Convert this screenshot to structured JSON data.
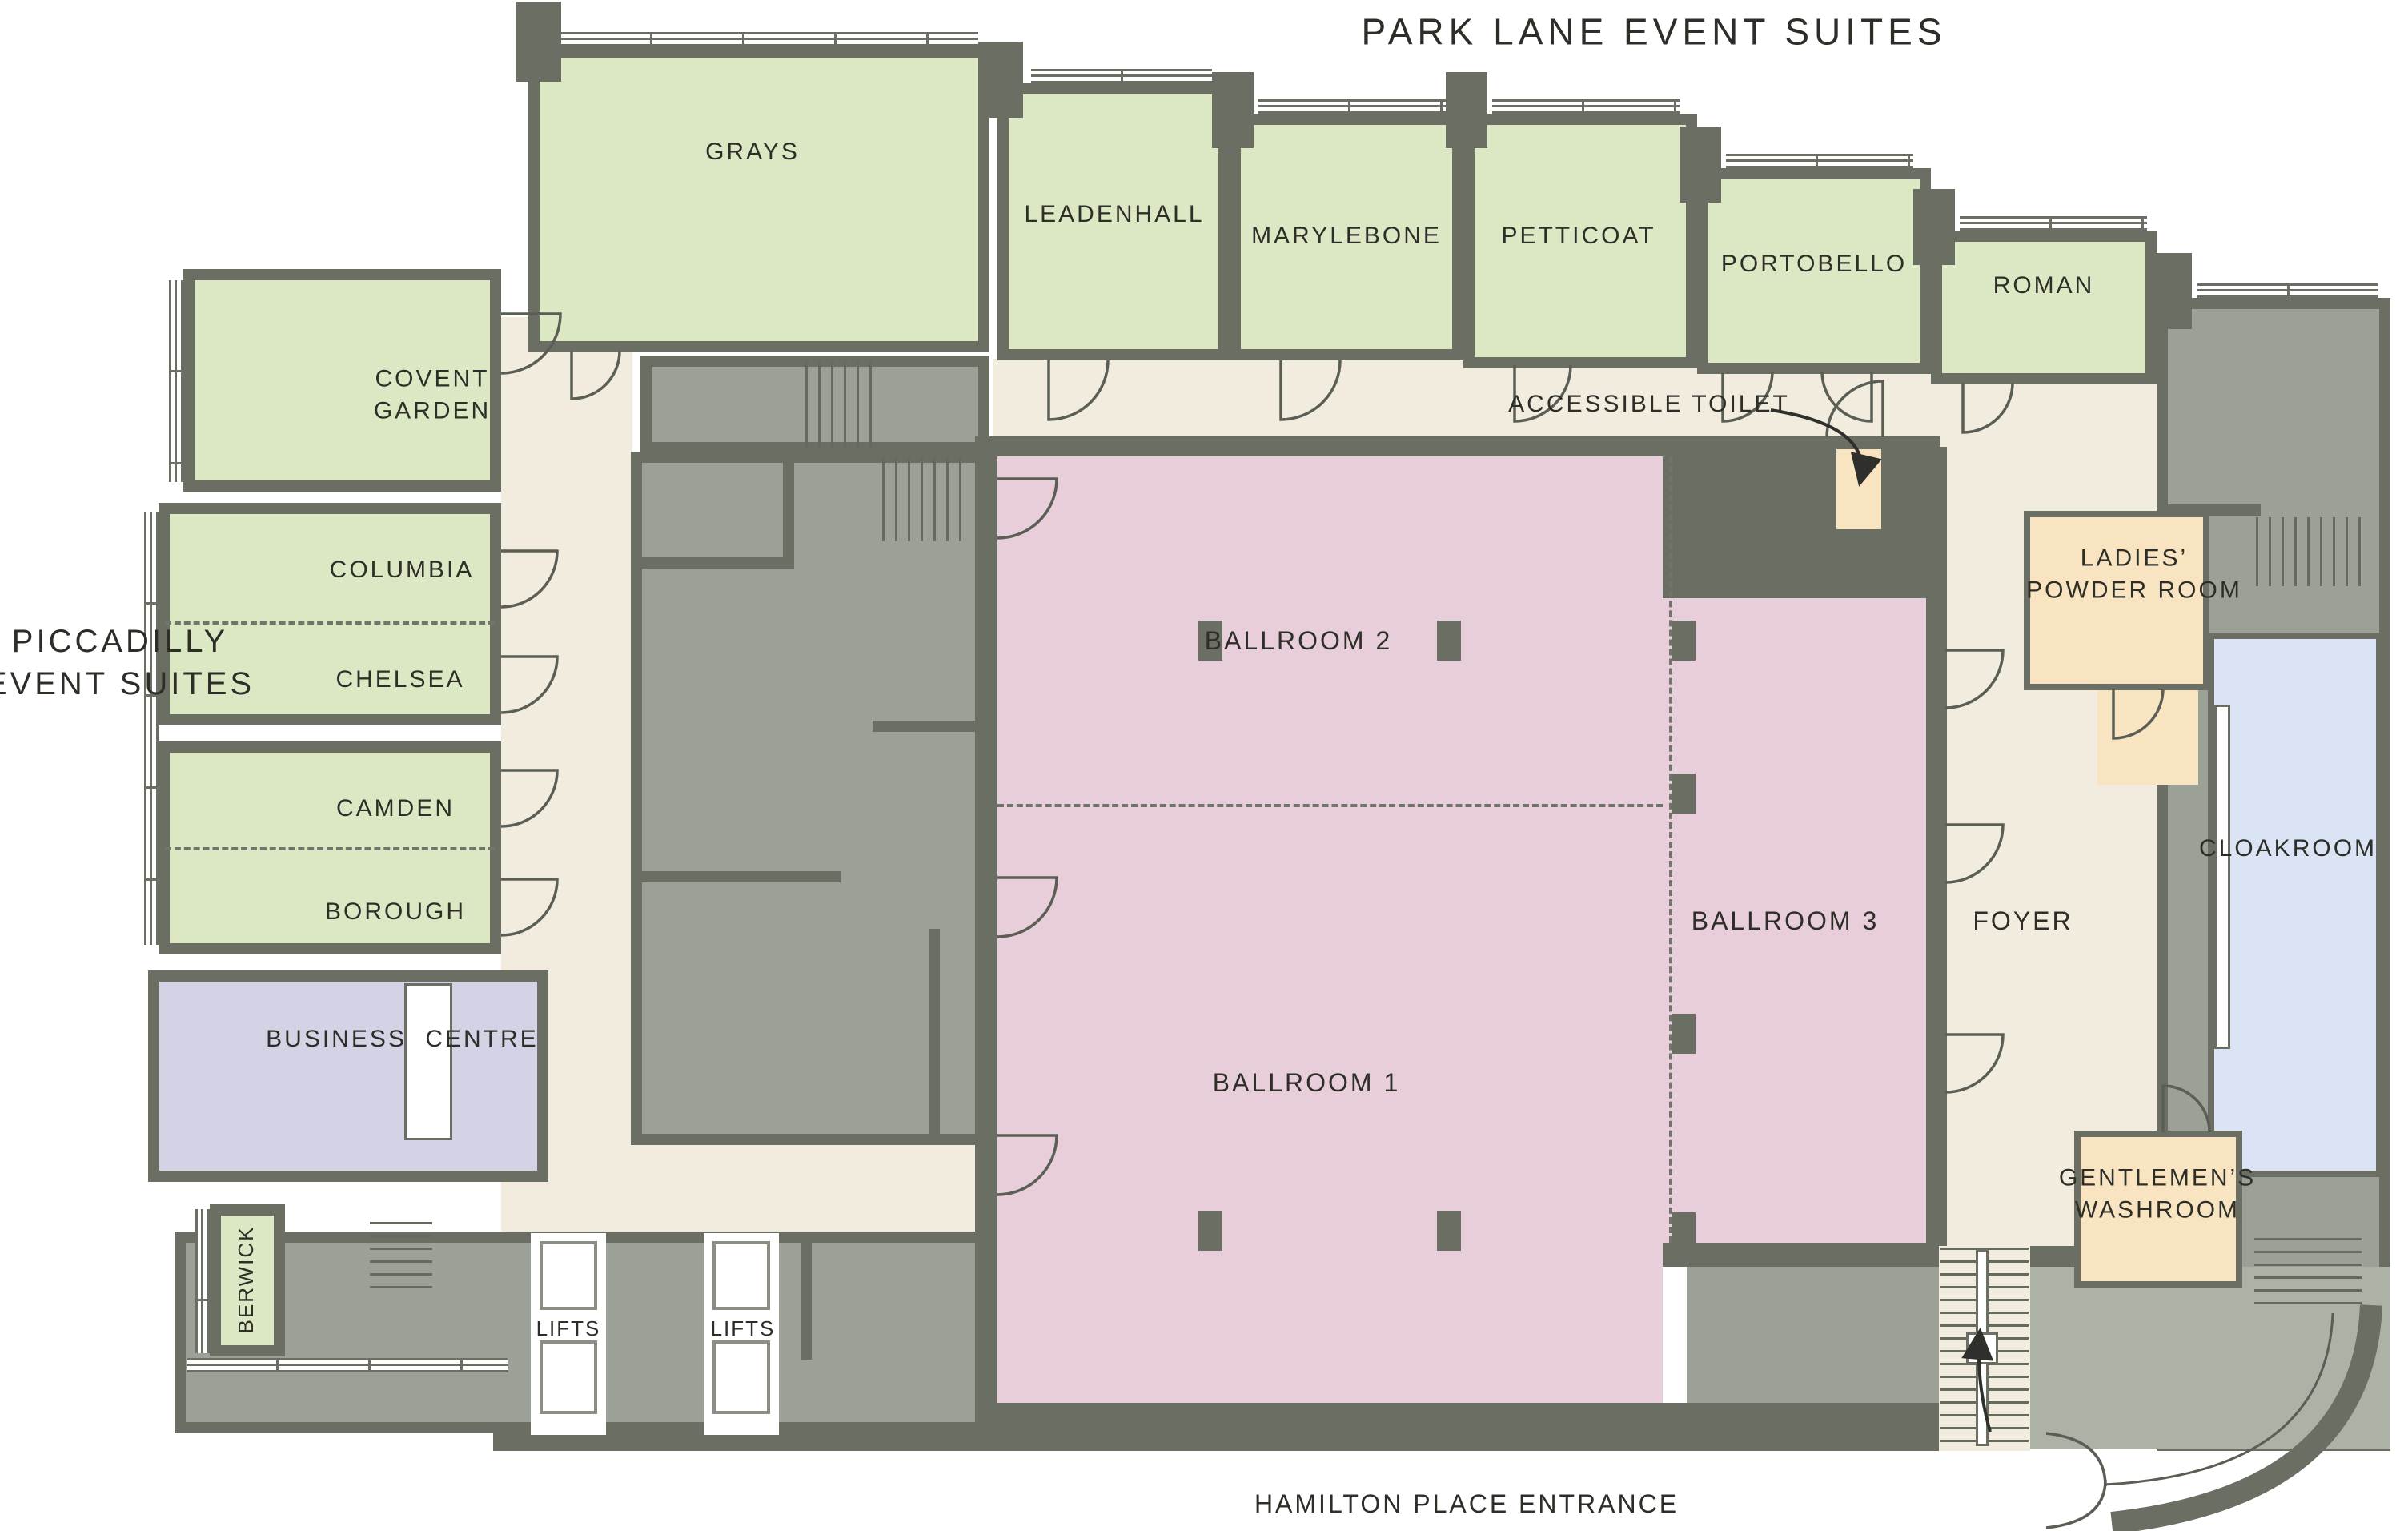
{
  "title": "PARK LANE EVENT SUITES",
  "left_title": {
    "line1": "PICCADILLY",
    "line2": "EVENT SUITES"
  },
  "annotations": {
    "accessible_toilet": "ACCESSIBLE TOILET",
    "entrance": "HAMILTON PLACE ENTRANCE"
  },
  "rooms": {
    "grays": "GRAYS",
    "leadenhall": "LEADENHALL",
    "marylebone": "MARYLEBONE",
    "petticoat": "PETTICOAT",
    "portobello": "PORTOBELLO",
    "roman": "ROMAN",
    "covent_garden_line1": "COVENT",
    "covent_garden_line2": "GARDEN",
    "columbia": "COLUMBIA",
    "chelsea": "CHELSEA",
    "camden": "CAMDEN",
    "borough": "BOROUGH",
    "business": "BUSINESS",
    "centre": "CENTRE",
    "berwick": "BERWICK",
    "ballroom1": "BALLROOM 1",
    "ballroom2": "BALLROOM 2",
    "ballroom3": "BALLROOM 3",
    "foyer": "FOYER",
    "ladies_line1": "LADIES’",
    "ladies_line2": "POWDER ROOM",
    "cloakroom": "CLOAKROOM",
    "gents_line1": "GENTLEMEN’S",
    "gents_line2": "WASHROOM",
    "lifts": "LIFTS"
  },
  "colors": {
    "event_suite_green": "#dce8c3",
    "ballroom_pink": "#e8cdda",
    "facility_tan": "#f8e4c1",
    "cloakroom_blue": "#dbe4f5",
    "business_centre_lavender": "#d4d3e6",
    "circulation_cream": "#f2ecdf",
    "wall_gray": "#6a6e63",
    "back_of_house_gray": "#9ba196"
  }
}
